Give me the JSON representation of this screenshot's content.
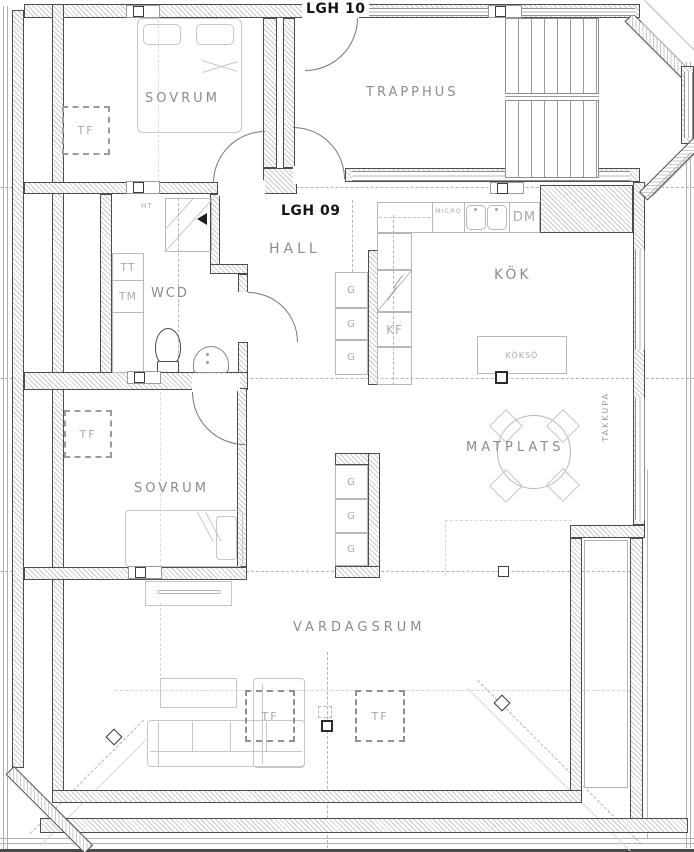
{
  "drawing": {
    "type": "floor-plan",
    "units": {
      "lgh10": "LGH 10",
      "lgh09": "LGH 09"
    },
    "rooms": {
      "sovrum_top": "SOVRUM",
      "trapphus": "TRAPPHUS",
      "hall": "HALL",
      "wcd": "WCD",
      "kok": "KÖK",
      "matplats": "MATPLATS",
      "sovrum_lower": "SOVRUM",
      "vardagsrum": "VARDAGSRUM"
    },
    "fixtures": {
      "tf": "TF",
      "tt": "TT",
      "tm": "TM",
      "ht": "HT",
      "g": "G",
      "kf": "KF",
      "dm": "DM",
      "micro": "MICRO",
      "kokso": "KÖKSÖ",
      "takkupa": "TAKKUPA"
    },
    "colors": {
      "wall_edge": "#4d4d4d",
      "hatch": "#c9c9c9",
      "furniture_line": "#c6c6c6",
      "label_text": "#8c8c8c",
      "unit_label_text": "#141414",
      "background": "#ffffff"
    }
  }
}
